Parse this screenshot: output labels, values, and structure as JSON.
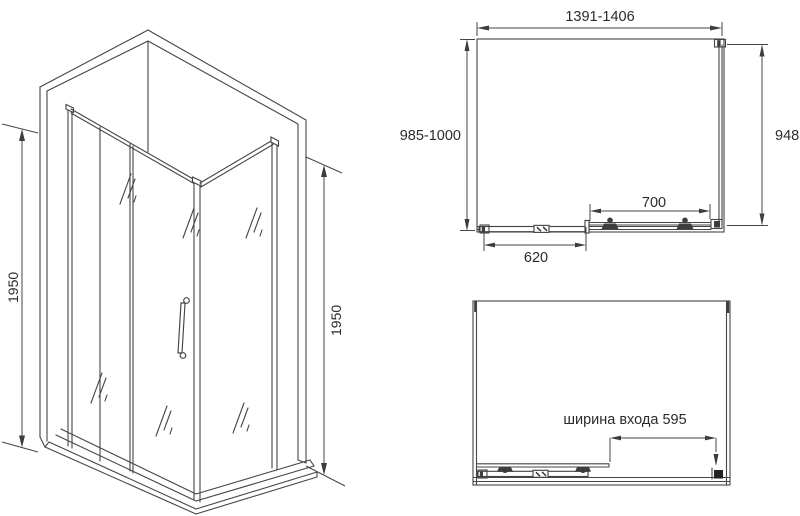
{
  "colors": {
    "background": "#ffffff",
    "line": "#454545",
    "text": "#2b2b2b",
    "dark_fill": "#3d3d3d"
  },
  "isometric_view": {
    "height_left": "1950",
    "height_right": "1950"
  },
  "plan_view_closed": {
    "width_range": "1391-1406",
    "depth_range": "985-1000",
    "side_panel_width": "948",
    "door_travel_width": "700",
    "fixed_panel_width": "620"
  },
  "plan_view_open": {
    "entry_width_label": "ширина входа 595"
  }
}
